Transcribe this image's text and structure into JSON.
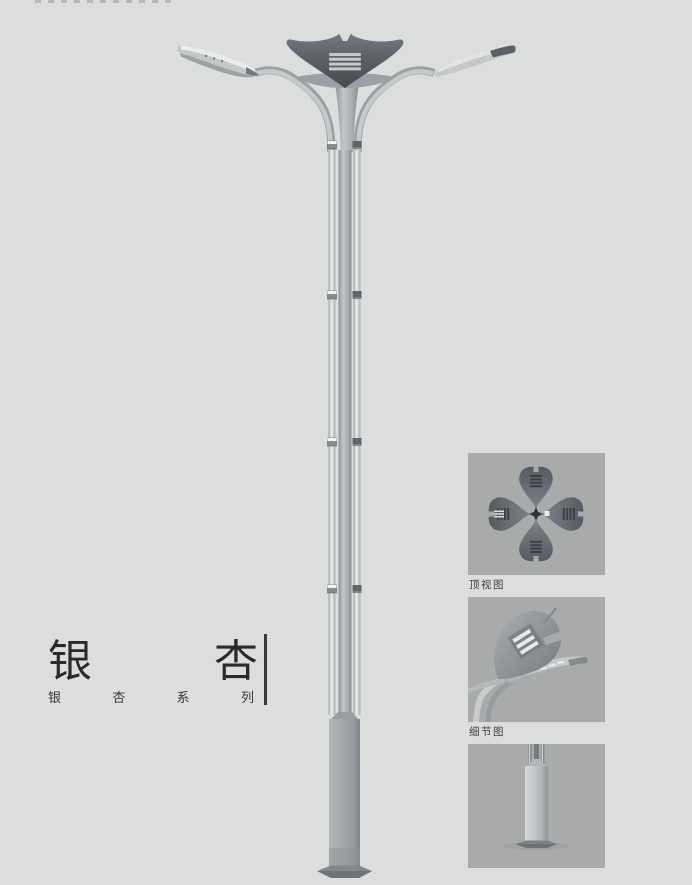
{
  "page": {
    "background": "#dcdddd"
  },
  "title": {
    "text": "银杏",
    "chars": [
      "银",
      "杏"
    ]
  },
  "series": {
    "text": "银杏系列",
    "chars": [
      "银",
      "杏",
      "系",
      "列"
    ]
  },
  "detail_panels": [
    {
      "caption": "顶视图"
    },
    {
      "caption": "细节图"
    },
    {
      "caption": ""
    }
  ],
  "colors": {
    "page_background": "#dcdddd",
    "panel_background": "#a9abab",
    "title_text": "#2b2a28",
    "caption_text": "#3e3e3c",
    "divider_line": "#3a3938",
    "lamp_dark": "#5a5f66",
    "lamp_mid": "#9aa0a5",
    "lamp_light": "#c7c9cb"
  }
}
